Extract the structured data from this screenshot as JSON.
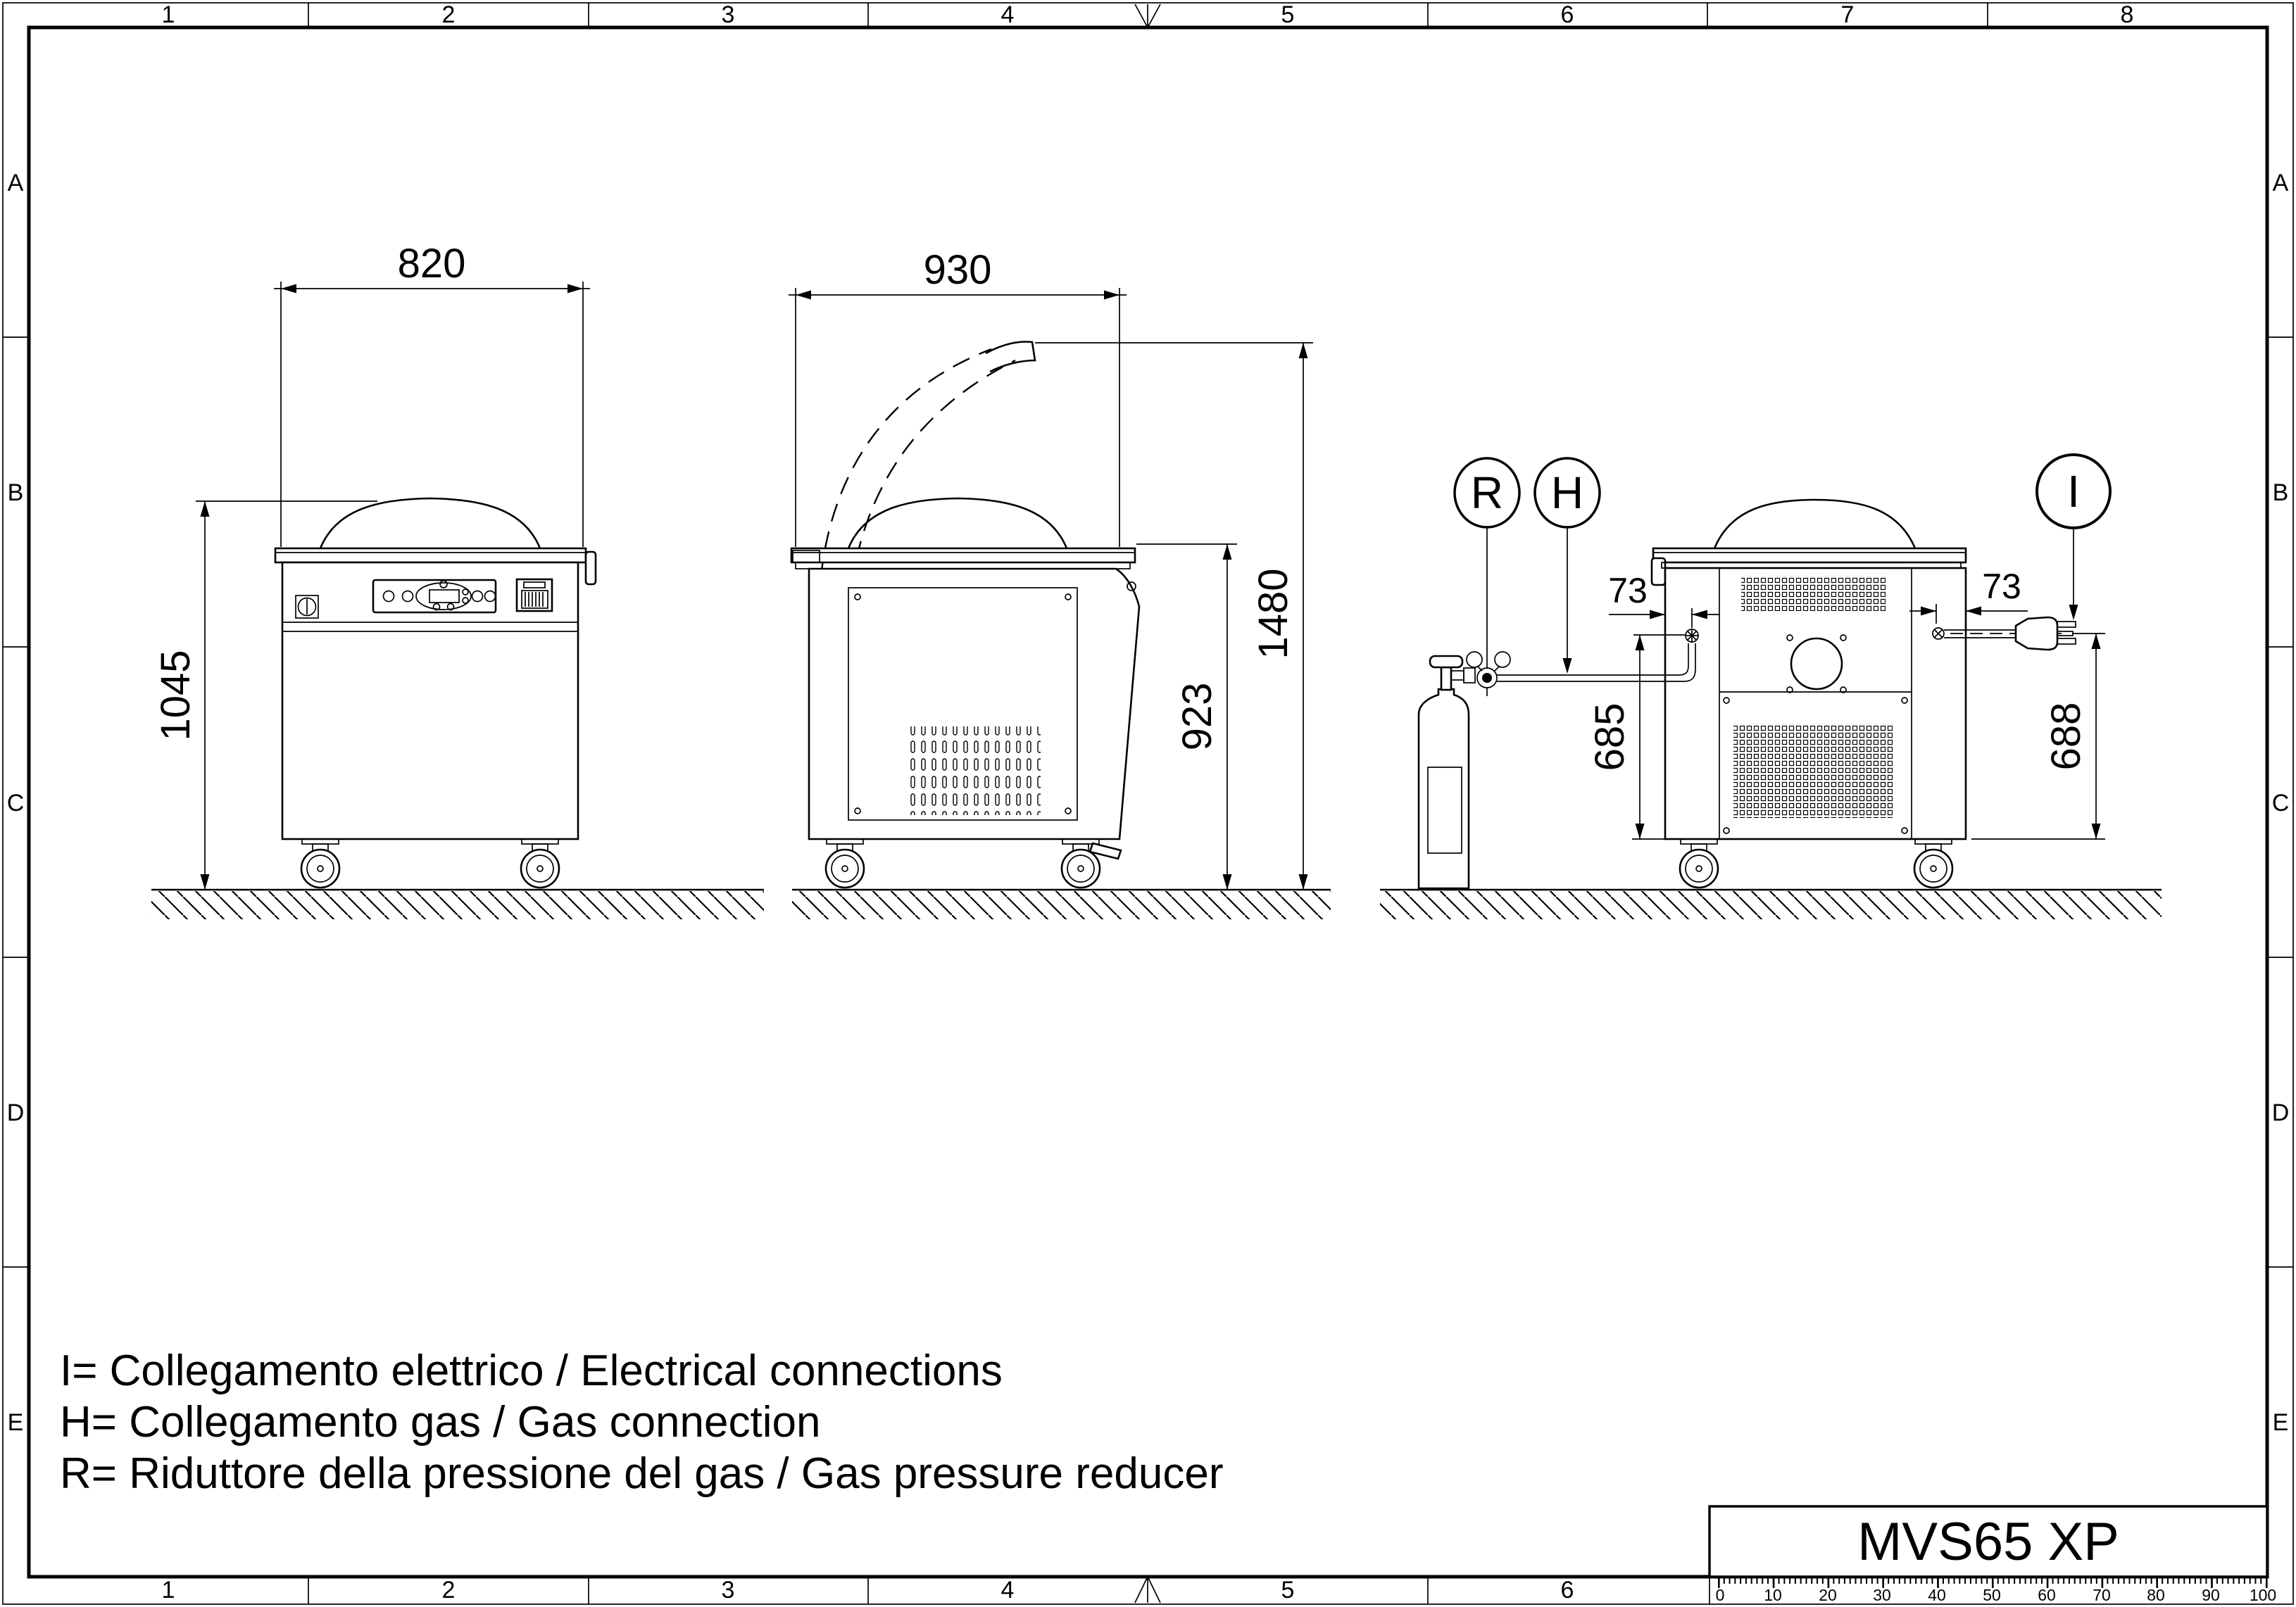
{
  "frame": {
    "columns": [
      "1",
      "2",
      "3",
      "4",
      "5",
      "6",
      "7",
      "8"
    ],
    "rows": [
      "A",
      "B",
      "C",
      "D",
      "E"
    ]
  },
  "dimensions": {
    "front_width": "820",
    "front_height": "1045",
    "side_width": "930",
    "side_open_height": "1480",
    "side_closed_height": "923",
    "rear_gas_offset": "73",
    "rear_power_offset": "73",
    "rear_gas_height": "685",
    "rear_power_height": "688"
  },
  "callouts": {
    "gas_pressure_reducer": "R",
    "gas_connection": "H",
    "electrical_connection": "I"
  },
  "legend": {
    "lines": [
      "I= Collegamento elettrico / Electrical connections",
      "H= Collegamento gas / Gas connection",
      "R= Riduttore della pressione del gas / Gas pressure reducer"
    ]
  },
  "title_block": {
    "model": "MVS65 XP"
  },
  "ruler": {
    "labels": [
      "0",
      "10",
      "20",
      "30",
      "40",
      "50",
      "60",
      "70",
      "80",
      "90",
      "100"
    ]
  },
  "colors": {
    "line": "#000000",
    "background": "#ffffff"
  }
}
